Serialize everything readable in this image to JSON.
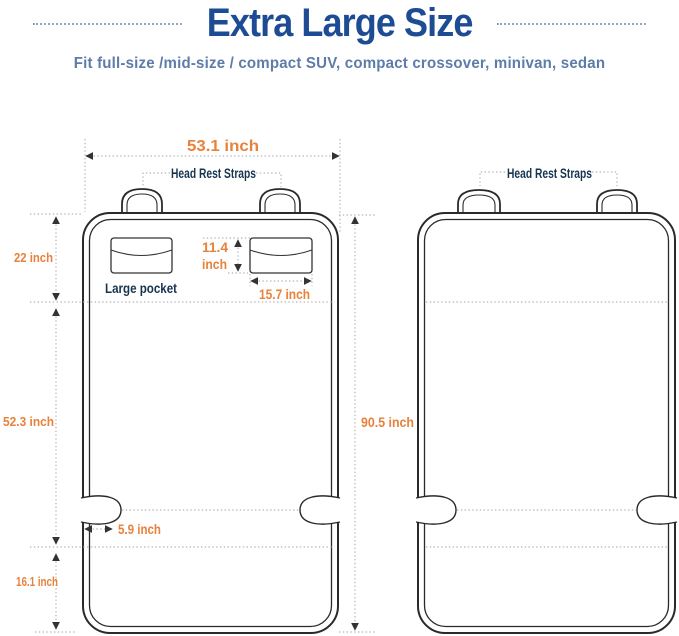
{
  "header": {
    "title": "Extra Large Size",
    "subtitle": "Fit full-size /mid-size / compact SUV, compact crossover, minivan, sedan"
  },
  "colors": {
    "title_blue": "#1d4b94",
    "subtitle_blue": "#5d7ca9",
    "dimension_orange": "#e8813a",
    "label_navy": "#16334f",
    "outline_dark": "#2a2a2a",
    "guide_gray": "#b3b3b3"
  },
  "left_diagram": {
    "width": "53.1 inch",
    "head_rest_straps": "Head Rest Straps",
    "top_section_height": "22 inch",
    "pocket_height_value": "11.4",
    "pocket_height_unit": "inch",
    "pocket_label": "Large pocket",
    "pocket_width": "15.7 inch",
    "middle_section_height": "52.3  inch",
    "notch_depth": "5.9 inch",
    "bottom_section_height": "16.1 inch"
  },
  "right_diagram": {
    "head_rest_straps": "Head Rest Straps",
    "total_height": "90.5  inch"
  }
}
